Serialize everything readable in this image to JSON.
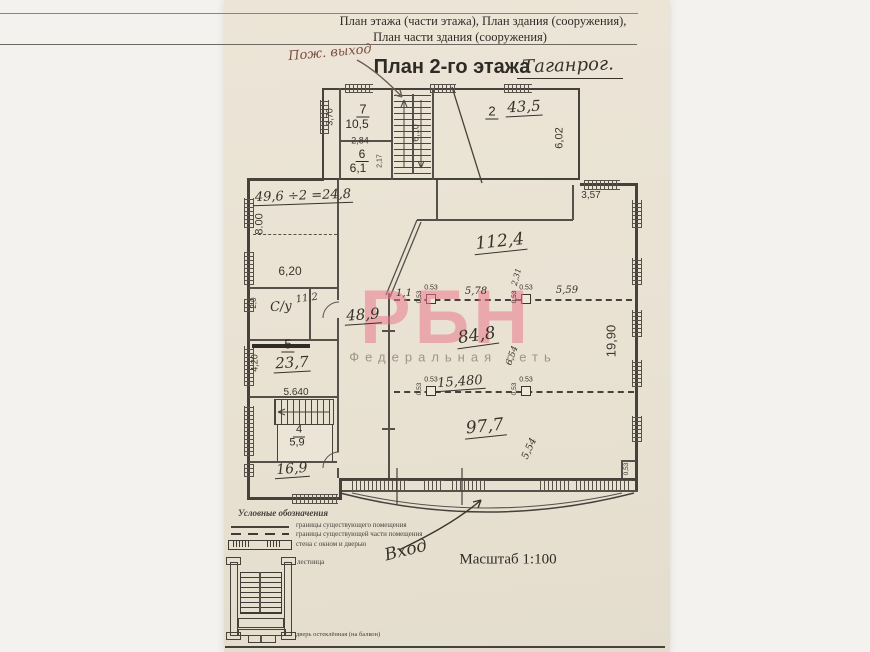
{
  "header": {
    "line1": "План этажа (части этажа), План здания (сооружения),",
    "line2": "План части здания (сооружения)",
    "fire_exit_note": "Пож. выход",
    "title": "План 2-го этажа",
    "title_city": "Таганрог."
  },
  "watermark": {
    "logo": "РБН",
    "subtitle": "Федеральная сеть"
  },
  "rooms": {
    "r7": {
      "number": "7",
      "area": "10,5"
    },
    "r6": {
      "number": "6",
      "area": "6,1"
    },
    "r2": {
      "number": "2",
      "area": "43,5"
    },
    "r5": {
      "number": "5",
      "area": "23,7"
    },
    "r4": {
      "number": "4",
      "area": "5,9"
    },
    "su": {
      "label": "С/у",
      "area": "11,2"
    },
    "left_room_calc": "49,6 ÷2 =24,8",
    "corridor_area": "48,9",
    "hall_top_area": "112,4",
    "hall_mid_area": "84,8",
    "hall_bottom_area": "97,7",
    "bottom_left_area": "16,9"
  },
  "dims": {
    "d370": "3,70",
    "d284": "2,84",
    "d217": "2,17",
    "d610": "6,10",
    "d602": "6,02",
    "d357": "3,57",
    "d800": "8.00",
    "d620": "6,20",
    "d20": "2,0",
    "d420": "4,20",
    "d5640": "5.640",
    "d1990": "19,90",
    "d15480": "15,480",
    "d578": "5,78",
    "d559": "5,59",
    "d554": "5,54",
    "d654": "6,54",
    "d231": "2,31",
    "d11": "1,1",
    "c053": "0.53",
    "c053r": "0,53"
  },
  "annotations": {
    "entrance": "Вход",
    "scale": "Масштаб 1:100"
  },
  "legend": {
    "title": "Условные обозначения",
    "items": [
      "границы существующего помещения",
      "границы существующей части помещения",
      "стена с окном и дверью",
      "лестница",
      "дверь остеклённая (на балкон)"
    ]
  }
}
